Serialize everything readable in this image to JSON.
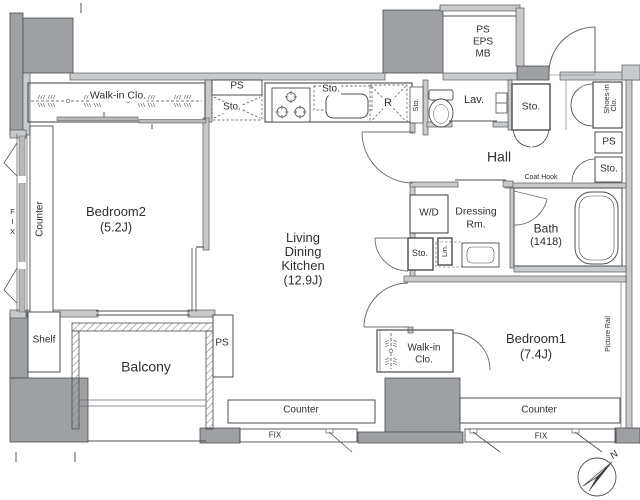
{
  "colors": {
    "background": "#ffffff",
    "wall_fill": "#c9cacc",
    "column_fill": "#9ea0a4",
    "line": "#4a4c4f",
    "text": "#2e2f32"
  },
  "areas": {
    "bedroom2": {
      "name": "Bedroom2",
      "size": "(5.2J)",
      "closet": "Walk-in Clo.",
      "counter": "Counter",
      "window": "FIX",
      "shelf": "Shelf"
    },
    "kitchen": {
      "ps": "PS",
      "sto_corner": "Sto.",
      "sto_overhead": "Sto.",
      "fridge": "R",
      "sto_end": "Sto."
    },
    "ldk": {
      "name_lines": [
        "Living",
        "Dining",
        "Kitchen"
      ],
      "size": "(12.9J)",
      "counter": "Counter",
      "window": "FIX"
    },
    "hall": {
      "name": "Hall",
      "sto": "Sto.",
      "shoes_closet": [
        "Shoes-in",
        "Clo."
      ],
      "ps": "PS",
      "sto2": "Sto.",
      "coat_hook": "Coat Hook"
    },
    "lavatory": {
      "name": "Lav."
    },
    "utility_shaft": {
      "lines": [
        "PS",
        "EPS",
        "MB"
      ]
    },
    "dressing": {
      "name_lines": [
        "Dressing",
        "Rm."
      ],
      "washer": "W/D",
      "sto": "Sto.",
      "linen": "Lin."
    },
    "bath": {
      "name": "Bath",
      "size": "(1418)"
    },
    "bedroom1": {
      "name": "Bedroom1",
      "size": "(7.4J)",
      "closet_lines": [
        "Walk-in",
        "Clo."
      ],
      "picture_rail": "Picture Rail",
      "counter": "Counter",
      "window": "FIX"
    },
    "balcony": {
      "name": "Balcony",
      "ps": "PS"
    },
    "compass": {
      "north": "N"
    }
  }
}
